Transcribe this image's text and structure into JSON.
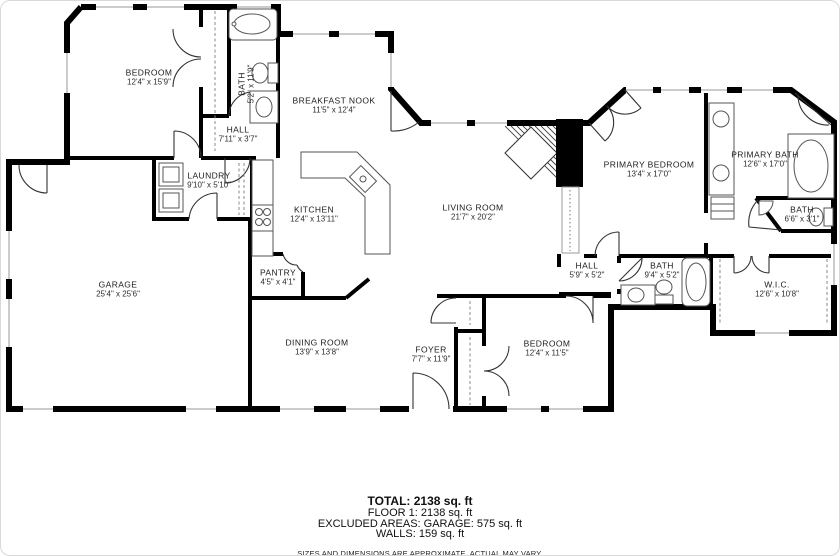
{
  "rooms": [
    {
      "id": "bedroom-top",
      "name": "BEDROOM",
      "dims": "12'4\" x 15'9\""
    },
    {
      "id": "bath-top",
      "name": "BATH",
      "dims": "5'2\" x 11'9\""
    },
    {
      "id": "hall-top",
      "name": "HALL",
      "dims": "7'11\" x 3'7\""
    },
    {
      "id": "breakfast-nook",
      "name": "BREAKFAST NOOK",
      "dims": "11'5\" x 12'4\""
    },
    {
      "id": "laundry",
      "name": "LAUNDRY",
      "dims": "9'10\" x 5'10\""
    },
    {
      "id": "kitchen",
      "name": "KITCHEN",
      "dims": "12'4\" x 13'11\""
    },
    {
      "id": "pantry",
      "name": "PANTRY",
      "dims": "4'5\" x 4'1\""
    },
    {
      "id": "living-room",
      "name": "LIVING ROOM",
      "dims": "21'7\" x 20'2\""
    },
    {
      "id": "primary-bedroom",
      "name": "PRIMARY BEDROOM",
      "dims": "13'4\" x 17'0\""
    },
    {
      "id": "primary-bath",
      "name": "PRIMARY BATH",
      "dims": "12'6\" x 17'0\""
    },
    {
      "id": "bath-small",
      "name": "BATH",
      "dims": "6'6\" x 3'1\""
    },
    {
      "id": "hall-rear",
      "name": "HALL",
      "dims": "5'9\" x 5'2\""
    },
    {
      "id": "bath-rear",
      "name": "BATH",
      "dims": "9'4\" x 5'2\""
    },
    {
      "id": "wic",
      "name": "W.I.C.",
      "dims": "12'6\" x 10'8\""
    },
    {
      "id": "garage",
      "name": "GARAGE",
      "dims": "25'4\" x 25'6\""
    },
    {
      "id": "dining-room",
      "name": "DINING ROOM",
      "dims": "13'9\" x 13'8\""
    },
    {
      "id": "foyer",
      "name": "FOYER",
      "dims": "7'7\" x 11'9\""
    },
    {
      "id": "bedroom-bottom",
      "name": "BEDROOM",
      "dims": "12'4\" x 11'5\""
    }
  ],
  "footer": {
    "total": "TOTAL: 2138 sq. ft",
    "floor": "FLOOR 1: 2138 sq. ft",
    "excluded": "EXCLUDED AREAS: GARAGE: 575 sq. ft",
    "walls": "WALLS: 159 sq. ft",
    "disclaimer": "SIZES AND DIMENSIONS ARE APPROXIMATE, ACTUAL MAY VARY."
  },
  "colors": {
    "wall": "#000000",
    "fixture": "#555555",
    "dash": "#888888",
    "text": "#1c1c1c"
  }
}
